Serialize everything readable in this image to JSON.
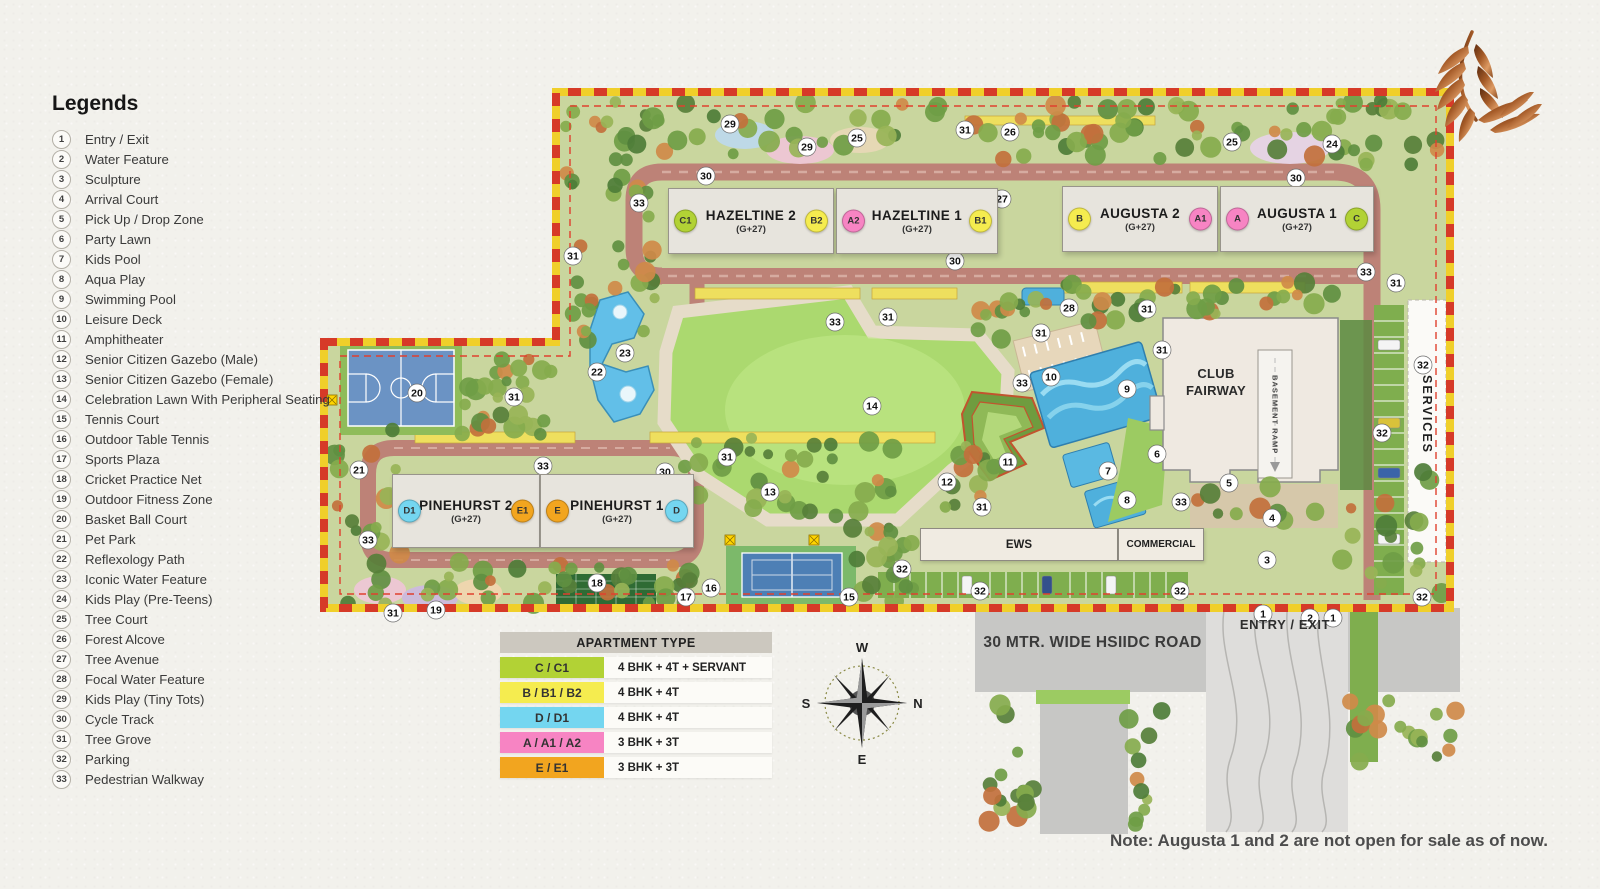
{
  "legend": {
    "title": "Legends",
    "items": [
      {
        "num": "1",
        "label": "Entry / Exit"
      },
      {
        "num": "2",
        "label": "Water Feature"
      },
      {
        "num": "3",
        "label": "Sculpture"
      },
      {
        "num": "4",
        "label": "Arrival Court"
      },
      {
        "num": "5",
        "label": "Pick Up / Drop Zone"
      },
      {
        "num": "6",
        "label": "Party Lawn"
      },
      {
        "num": "7",
        "label": "Kids Pool"
      },
      {
        "num": "8",
        "label": "Aqua Play"
      },
      {
        "num": "9",
        "label": "Swimming Pool"
      },
      {
        "num": "10",
        "label": "Leisure Deck"
      },
      {
        "num": "11",
        "label": "Amphitheater"
      },
      {
        "num": "12",
        "label": "Senior Citizen Gazebo (Male)"
      },
      {
        "num": "13",
        "label": "Senior Citizen Gazebo (Female)"
      },
      {
        "num": "14",
        "label": "Celebration Lawn With Peripheral Seating"
      },
      {
        "num": "15",
        "label": "Tennis Court"
      },
      {
        "num": "16",
        "label": "Outdoor Table Tennis"
      },
      {
        "num": "17",
        "label": "Sports Plaza"
      },
      {
        "num": "18",
        "label": "Cricket Practice Net"
      },
      {
        "num": "19",
        "label": "Outdoor Fitness Zone"
      },
      {
        "num": "20",
        "label": "Basket Ball Court"
      },
      {
        "num": "21",
        "label": "Pet Park"
      },
      {
        "num": "22",
        "label": "Reflexology Path"
      },
      {
        "num": "23",
        "label": "Iconic Water Feature"
      },
      {
        "num": "24",
        "label": "Kids Play (Pre-Teens)"
      },
      {
        "num": "25",
        "label": "Tree Court"
      },
      {
        "num": "26",
        "label": "Forest Alcove"
      },
      {
        "num": "27",
        "label": "Tree Avenue"
      },
      {
        "num": "28",
        "label": "Focal Water Feature"
      },
      {
        "num": "29",
        "label": "Kids Play (Tiny Tots)"
      },
      {
        "num": "30",
        "label": "Cycle Track"
      },
      {
        "num": "31",
        "label": "Tree Grove"
      },
      {
        "num": "32",
        "label": "Parking"
      },
      {
        "num": "33",
        "label": "Pedestrian Walkway"
      }
    ]
  },
  "apartment_table": {
    "header": "APARTMENT TYPE",
    "rows": [
      {
        "code": "C / C1",
        "desc": "4 BHK + 4T + SERVANT",
        "color": "#b2d235"
      },
      {
        "code": "B / B1 / B2",
        "desc": "4 BHK + 4T",
        "color": "#f5ec4f"
      },
      {
        "code": "D / D1",
        "desc": "4 BHK + 4T",
        "color": "#74d6f0"
      },
      {
        "code": "A / A1 / A2",
        "desc": "3 BHK + 3T",
        "color": "#f784c3"
      },
      {
        "code": "E / E1",
        "desc": "3 BHK + 3T",
        "color": "#f2a51f"
      }
    ]
  },
  "towers": [
    {
      "name": "HAZELTINE 2",
      "floors": "(G+27)",
      "badges": [
        {
          "code": "C1",
          "color": "#b2d235"
        },
        {
          "code": "B2",
          "color": "#f5ec4f"
        }
      ]
    },
    {
      "name": "HAZELTINE 1",
      "floors": "(G+27)",
      "badges": [
        {
          "code": "A2",
          "color": "#f784c3"
        },
        {
          "code": "B1",
          "color": "#f5ec4f"
        }
      ]
    },
    {
      "name": "AUGUSTA 2",
      "floors": "(G+27)",
      "badges": [
        {
          "code": "B",
          "color": "#f5ec4f"
        },
        {
          "code": "A1",
          "color": "#f784c3"
        }
      ]
    },
    {
      "name": "AUGUSTA 1",
      "floors": "(G+27)",
      "badges": [
        {
          "code": "A",
          "color": "#f784c3"
        },
        {
          "code": "C",
          "color": "#b2d235"
        }
      ]
    },
    {
      "name": "PINEHURST 2",
      "floors": "(G+27)",
      "badges": [
        {
          "code": "D1",
          "color": "#74d6f0"
        },
        {
          "code": "E1",
          "color": "#f2a51f"
        }
      ]
    },
    {
      "name": "PINEHURST 1",
      "floors": "(G+27)",
      "badges": [
        {
          "code": "E",
          "color": "#f2a51f"
        },
        {
          "code": "D",
          "color": "#74d6f0"
        }
      ]
    }
  ],
  "club": {
    "line1": "CLUB",
    "line2": "FAIRWAY",
    "basement_ramp": "BASEMENT RAMP"
  },
  "areas": {
    "ews": "EWS",
    "commercial": "COMMERCIAL",
    "services": "SERVICES"
  },
  "roads": {
    "main_road_label": "30 MTR. WIDE HSIIDC ROAD",
    "entry_exit_label": "ENTRY / EXIT"
  },
  "compass": {
    "north": "N",
    "south": "S",
    "east": "E",
    "west": "W"
  },
  "note": {
    "text": "Note: Augusta 1 and 2 are not open for sale as of now."
  },
  "map": {
    "markers": [
      {
        "n": "29",
        "x": 730,
        "y": 124
      },
      {
        "n": "29",
        "x": 807,
        "y": 147
      },
      {
        "n": "25",
        "x": 857,
        "y": 138
      },
      {
        "n": "31",
        "x": 965,
        "y": 130
      },
      {
        "n": "26",
        "x": 1010,
        "y": 132
      },
      {
        "n": "25",
        "x": 1232,
        "y": 142
      },
      {
        "n": "24",
        "x": 1332,
        "y": 144
      },
      {
        "n": "27",
        "x": 1002,
        "y": 199
      },
      {
        "n": "30",
        "x": 706,
        "y": 176
      },
      {
        "n": "33",
        "x": 639,
        "y": 203
      },
      {
        "n": "30",
        "x": 1296,
        "y": 178
      },
      {
        "n": "31",
        "x": 573,
        "y": 256
      },
      {
        "n": "30",
        "x": 955,
        "y": 261
      },
      {
        "n": "33",
        "x": 1366,
        "y": 272
      },
      {
        "n": "23",
        "x": 625,
        "y": 353
      },
      {
        "n": "22",
        "x": 597,
        "y": 372
      },
      {
        "n": "20",
        "x": 417,
        "y": 393
      },
      {
        "n": "31",
        "x": 514,
        "y": 397
      },
      {
        "n": "21",
        "x": 359,
        "y": 470
      },
      {
        "n": "33",
        "x": 543,
        "y": 466
      },
      {
        "n": "30",
        "x": 665,
        "y": 472
      },
      {
        "n": "33",
        "x": 368,
        "y": 540
      },
      {
        "n": "31",
        "x": 393,
        "y": 613
      },
      {
        "n": "19",
        "x": 436,
        "y": 610
      },
      {
        "n": "18",
        "x": 597,
        "y": 583
      },
      {
        "n": "17",
        "x": 686,
        "y": 597
      },
      {
        "n": "16",
        "x": 711,
        "y": 588
      },
      {
        "n": "15",
        "x": 849,
        "y": 597
      },
      {
        "n": "32",
        "x": 902,
        "y": 569
      },
      {
        "n": "33",
        "x": 835,
        "y": 322
      },
      {
        "n": "31",
        "x": 888,
        "y": 317
      },
      {
        "n": "14",
        "x": 872,
        "y": 406
      },
      {
        "n": "31",
        "x": 727,
        "y": 457
      },
      {
        "n": "13",
        "x": 770,
        "y": 492
      },
      {
        "n": "12",
        "x": 947,
        "y": 482
      },
      {
        "n": "31",
        "x": 982,
        "y": 507
      },
      {
        "n": "11",
        "x": 1008,
        "y": 462
      },
      {
        "n": "28",
        "x": 1069,
        "y": 308
      },
      {
        "n": "31",
        "x": 1041,
        "y": 333
      },
      {
        "n": "31",
        "x": 1147,
        "y": 309
      },
      {
        "n": "31",
        "x": 1162,
        "y": 350
      },
      {
        "n": "10",
        "x": 1051,
        "y": 377
      },
      {
        "n": "9",
        "x": 1127,
        "y": 389
      },
      {
        "n": "33",
        "x": 1022,
        "y": 383
      },
      {
        "n": "6",
        "x": 1157,
        "y": 454
      },
      {
        "n": "7",
        "x": 1108,
        "y": 471
      },
      {
        "n": "8",
        "x": 1127,
        "y": 500
      },
      {
        "n": "33",
        "x": 1181,
        "y": 502
      },
      {
        "n": "5",
        "x": 1229,
        "y": 483
      },
      {
        "n": "4",
        "x": 1272,
        "y": 518
      },
      {
        "n": "3",
        "x": 1267,
        "y": 560
      },
      {
        "n": "1",
        "x": 1263,
        "y": 614
      },
      {
        "n": "2",
        "x": 1310,
        "y": 618
      },
      {
        "n": "1",
        "x": 1333,
        "y": 618
      },
      {
        "n": "31",
        "x": 1396,
        "y": 283
      },
      {
        "n": "32",
        "x": 1423,
        "y": 365
      },
      {
        "n": "32",
        "x": 1382,
        "y": 433
      },
      {
        "n": "32",
        "x": 1422,
        "y": 597
      },
      {
        "n": "32",
        "x": 980,
        "y": 591
      },
      {
        "n": "32",
        "x": 1180,
        "y": 591
      }
    ]
  },
  "colors": {
    "boundary_red": "#d63a28",
    "boundary_yellow": "#f0cf2a",
    "road": "#bd8277",
    "lawn": "#abd96f",
    "water": "#4fb0dc",
    "type_c": "#b2d235",
    "type_b": "#f5ec4f",
    "type_d": "#74d6f0",
    "type_a": "#f784c3",
    "type_e": "#f2a51f"
  }
}
